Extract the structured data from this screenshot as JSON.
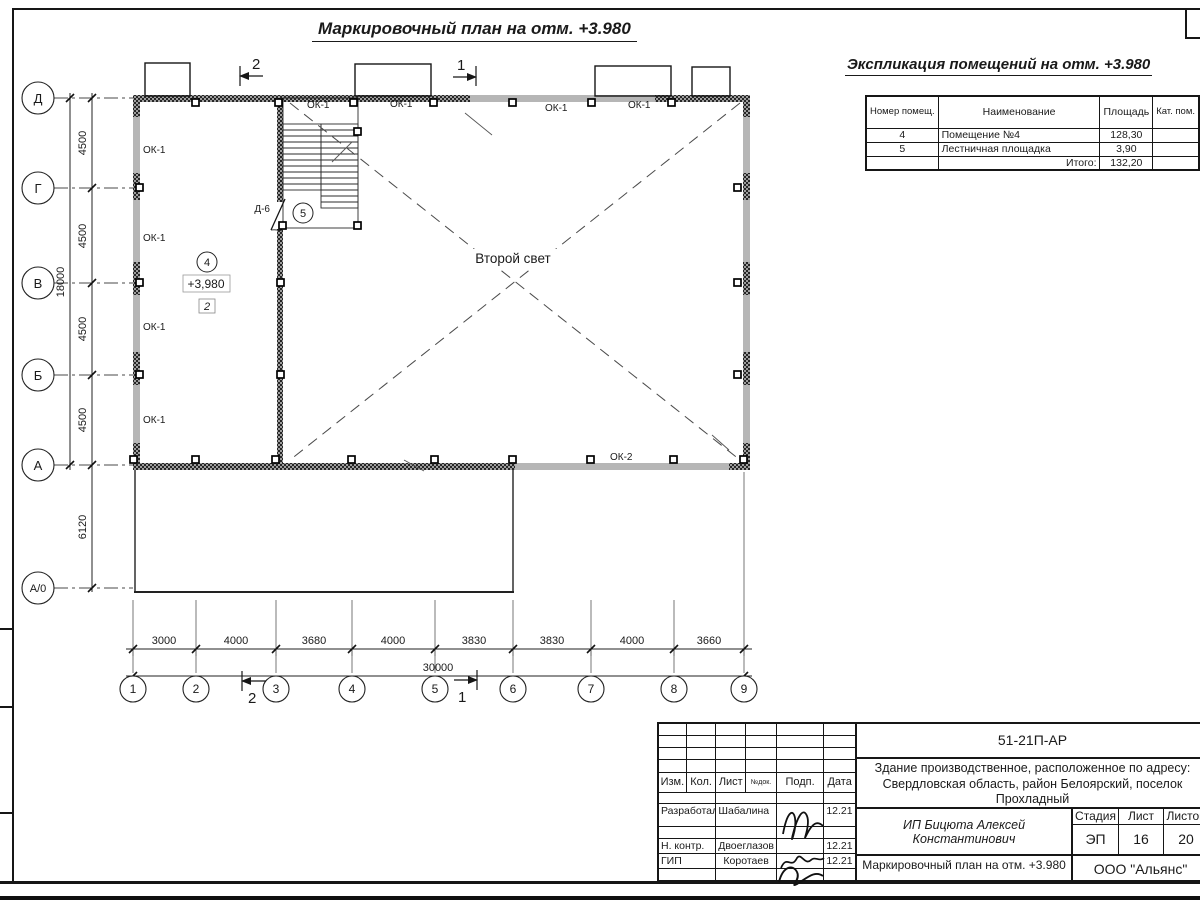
{
  "page_title": "Маркировочный план на отм. +3.980",
  "explication": {
    "title": "Экспликация помещений на отм. +3.980",
    "col_number": "Номер помещ.",
    "col_name": "Наименование",
    "col_area": "Площадь",
    "col_cat": "Кат. пом.",
    "rows": [
      {
        "number": "4",
        "name": "Помещение №4",
        "area": "128,30",
        "cat": ""
      },
      {
        "number": "5",
        "name": "Лестничная площадка",
        "area": "3,90",
        "cat": ""
      }
    ],
    "total_label": "Итого:",
    "total_area": "132,20"
  },
  "plan": {
    "void_label": "Второй свет",
    "window1": "ОК-1",
    "window2": "ОК-2",
    "door": "Д-6",
    "room4": {
      "number": "4",
      "elevation": "+3,980",
      "zone": "2"
    },
    "room5": {
      "number": "5"
    },
    "section_1": "1",
    "section_2": "2"
  },
  "axes": {
    "rows": [
      "Д",
      "Г",
      "В",
      "Б",
      "А",
      "А/0"
    ],
    "cols": [
      "1",
      "2",
      "3",
      "4",
      "5",
      "6",
      "7",
      "8",
      "9"
    ]
  },
  "dims": {
    "v": [
      "4500",
      "4500",
      "4500",
      "4500"
    ],
    "v_low": "6120",
    "v_total": "18000",
    "h": [
      "3000",
      "4000",
      "3680",
      "4000",
      "3830",
      "3830",
      "4000",
      "3660"
    ],
    "h_total": "30000"
  },
  "title_block": {
    "code": "51-21П-АР",
    "object": "Здание производственное, расположенное по адресу: Свердловская область, район Белоярский, поселок Прохладный",
    "designer": "ИП Бицюта Алексей Константинович",
    "cols": {
      "izm": "Изм.",
      "kol": "Кол.",
      "list": "Лист",
      "ndok": "№док.",
      "podp": "Подп.",
      "data": "Дата"
    },
    "stage_label": "Стадия",
    "sheet_label": "Лист",
    "sheets_label": "Листов",
    "stage": "ЭП",
    "sheet": "16",
    "sheets": "20",
    "rows": [
      {
        "role": "Разработал",
        "name": "Шабалина",
        "date": "12.21"
      },
      {
        "role": "Н. контр.",
        "name": "Двоеглазов",
        "date": "12.21"
      },
      {
        "role": "ГИП",
        "name": "Коротаев",
        "date": "12.21"
      }
    ],
    "doc_title": "Маркировочный план на отм. +3.980",
    "company": "ООО \"Альянс\""
  }
}
